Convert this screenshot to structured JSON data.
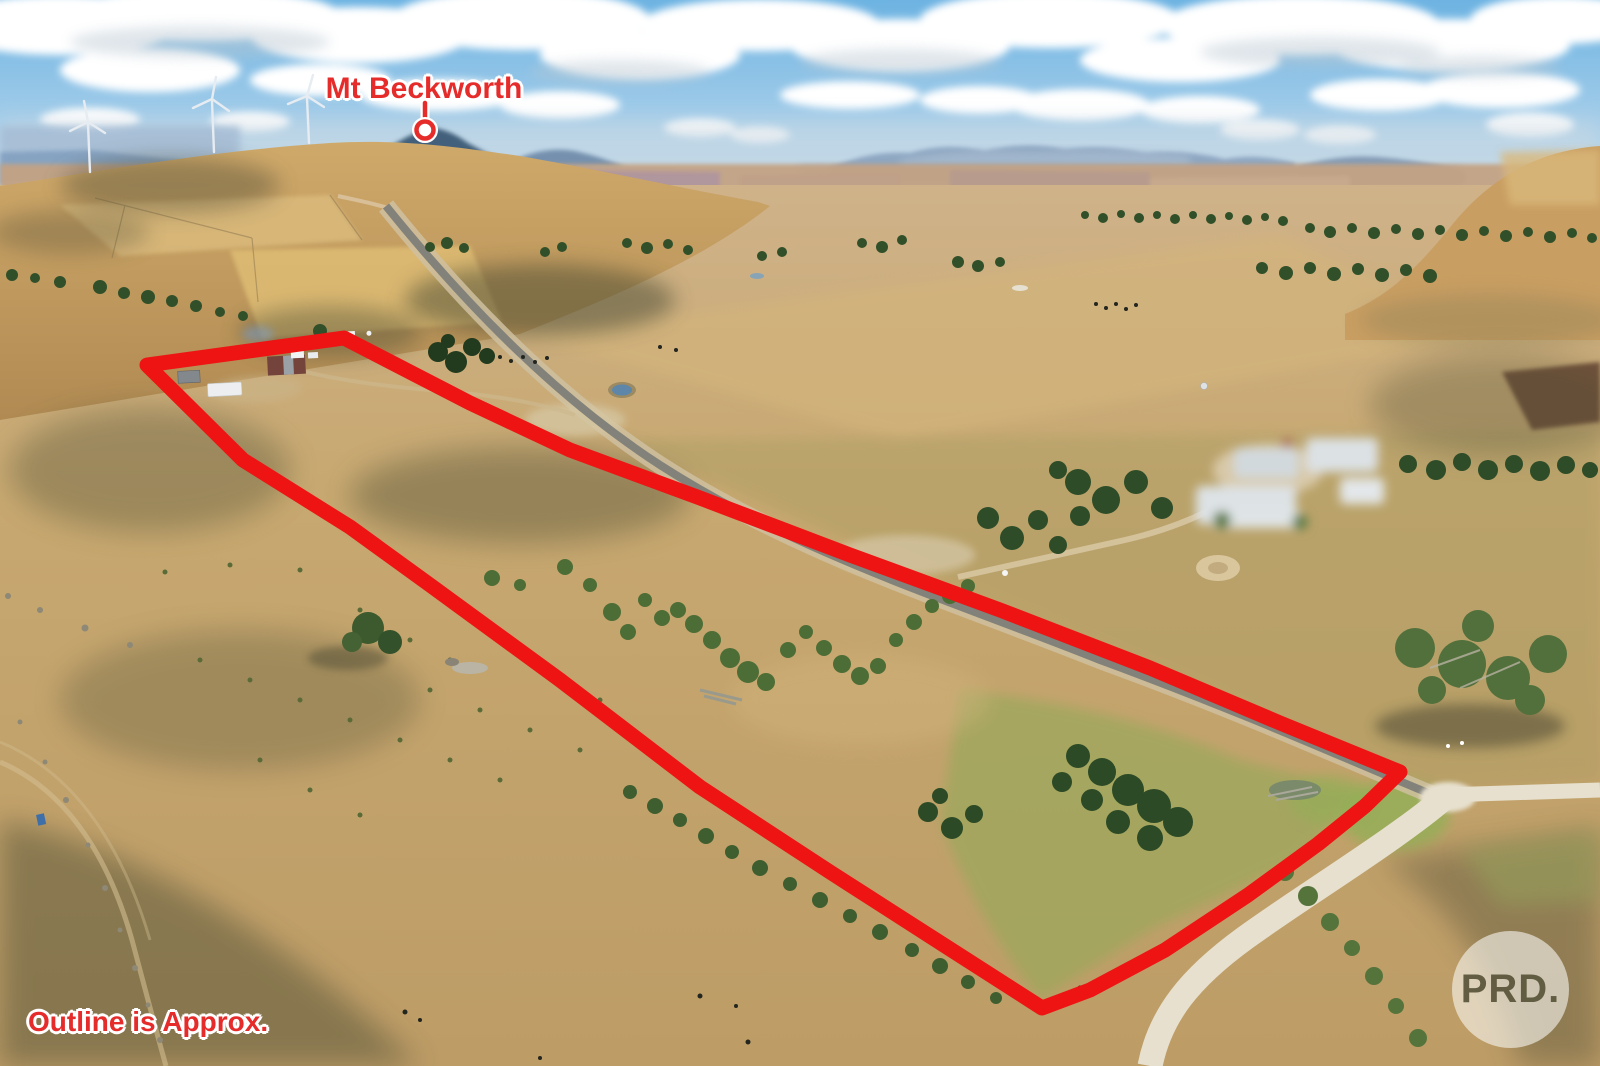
{
  "photo": {
    "description": "Aerial drone photograph of dry rural farmland with a red property boundary outline",
    "labels": {
      "mountain": "Mt Beckworth",
      "disclaimer": "Outline is Approx.",
      "watermark": "PRD."
    },
    "colors": {
      "outline_red": "#ee1414",
      "label_red": "#e62b2b",
      "label_halo": "#ffffff",
      "sky_blue": "#74b6e3",
      "grass_tan": "#c9a873",
      "tree_green": "#3c5a2e",
      "road_bitumen": "#82827a",
      "road_gravel": "#e7e0ce",
      "watermark_text": "#585438"
    },
    "icons": [
      "location-pin-icon"
    ]
  }
}
